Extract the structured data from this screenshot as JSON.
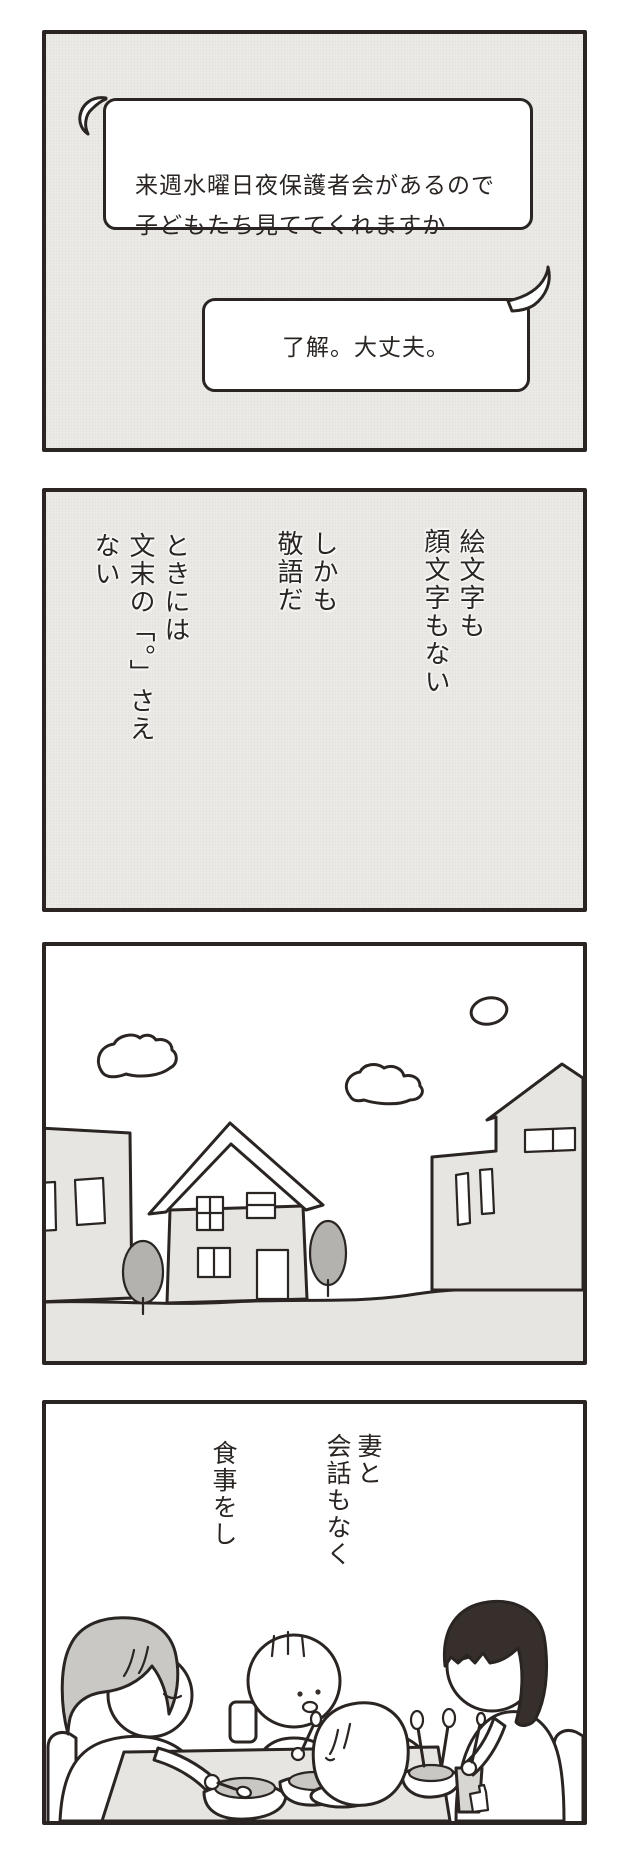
{
  "comic": {
    "panel1": {
      "bubble_left": "来週水曜日夜保護者会があるので\n子どもたち見ててくれますか",
      "bubble_right": "了解。大丈夫。"
    },
    "panel2": {
      "caption_right": "絵文字も\n顔文字もない",
      "caption_middle": "しかも\n敬語だ",
      "caption_left": "ときには\n文末の「。」さえ\nない"
    },
    "panel3": {
      "scene": "suburban houses with trees and clouds"
    },
    "panel4": {
      "caption_right": "妻と\n会話もなく",
      "caption_left": "食事をし",
      "scene": "family of four eating dinner in silence"
    }
  },
  "colors": {
    "ink": "#2a2522",
    "panel_grey": "#eae9e5",
    "light_grey_fill": "#e6e5e1",
    "mid_grey_fill": "#c8c7c3",
    "tree_grey": "#b3b2ae",
    "mother_hair_grey": "#c9c8c5",
    "father_hair_dark": "#362f2b",
    "cup_grey": "#d7d6d2",
    "white": "#ffffff"
  }
}
